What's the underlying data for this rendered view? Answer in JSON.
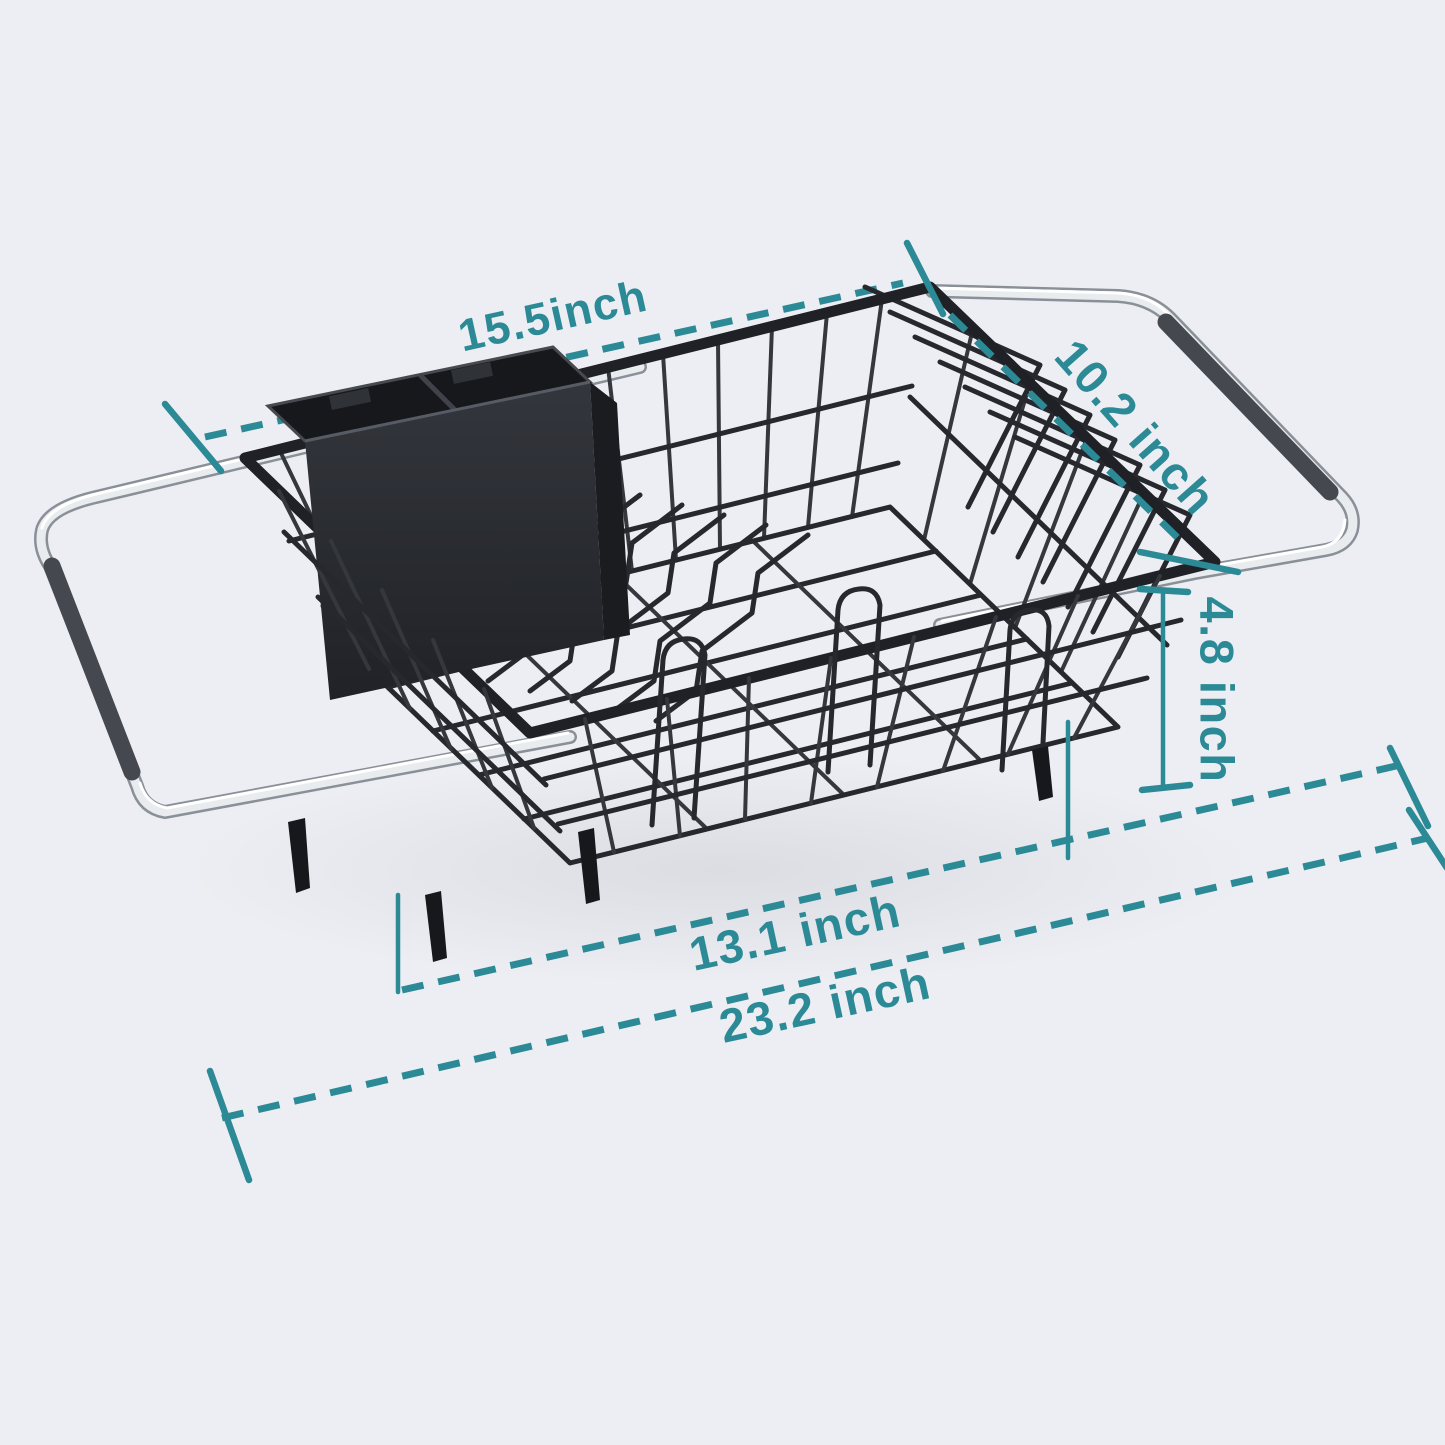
{
  "figure": {
    "type": "product-dimension-diagram",
    "subject": "expandable over-sink dish drying rack with utensil holder"
  },
  "colors": {
    "background": "#EDEEF3",
    "dimension_accent": "#2B8A95",
    "wire": "#26282D",
    "chrome": "#E9ECEF",
    "grip": "#45494F",
    "utensil_cup": "#2B2D32"
  },
  "dimensions": [
    {
      "id": "top-frame-width",
      "label": "15.5inch"
    },
    {
      "id": "depth",
      "label": "10.2 inch"
    },
    {
      "id": "height",
      "label": "4.8 inch"
    },
    {
      "id": "basket-width",
      "label": "13.1 inch"
    },
    {
      "id": "extended-width",
      "label": "23.2 inch"
    }
  ]
}
